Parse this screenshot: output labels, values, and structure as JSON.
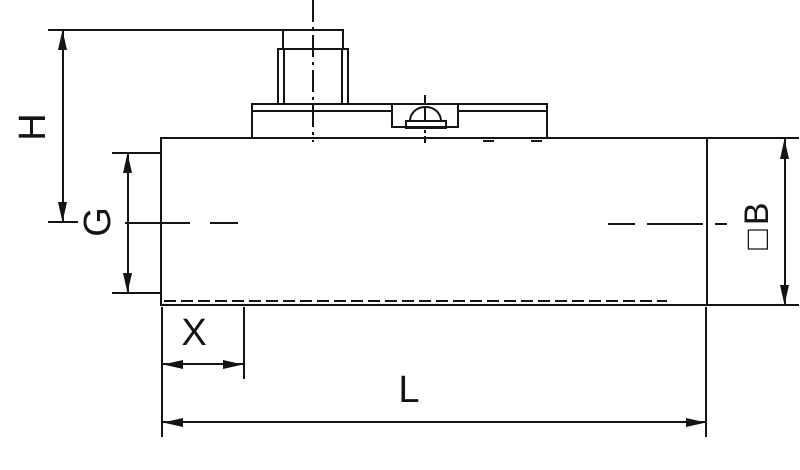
{
  "canvas": {
    "width": 800,
    "height": 470,
    "background": "#ffffff",
    "line_color": "#141414"
  },
  "drawing": {
    "type": "technical-dimension-drawing",
    "view": "side-view-with-top-connector-and-screw",
    "labels": {
      "H": "H",
      "G": "G",
      "X": "X",
      "L": "L",
      "B": "□B"
    },
    "dimensions": [
      {
        "id": "H",
        "label": "H",
        "orientation": "vertical",
        "location": "outer-left"
      },
      {
        "id": "G",
        "label": "G",
        "orientation": "vertical",
        "location": "inner-left"
      },
      {
        "id": "B",
        "label": "□B",
        "orientation": "vertical",
        "location": "right"
      },
      {
        "id": "X",
        "label": "X",
        "orientation": "horizontal",
        "location": "bottom-left"
      },
      {
        "id": "L",
        "label": "L",
        "orientation": "horizontal",
        "location": "bottom"
      }
    ]
  }
}
